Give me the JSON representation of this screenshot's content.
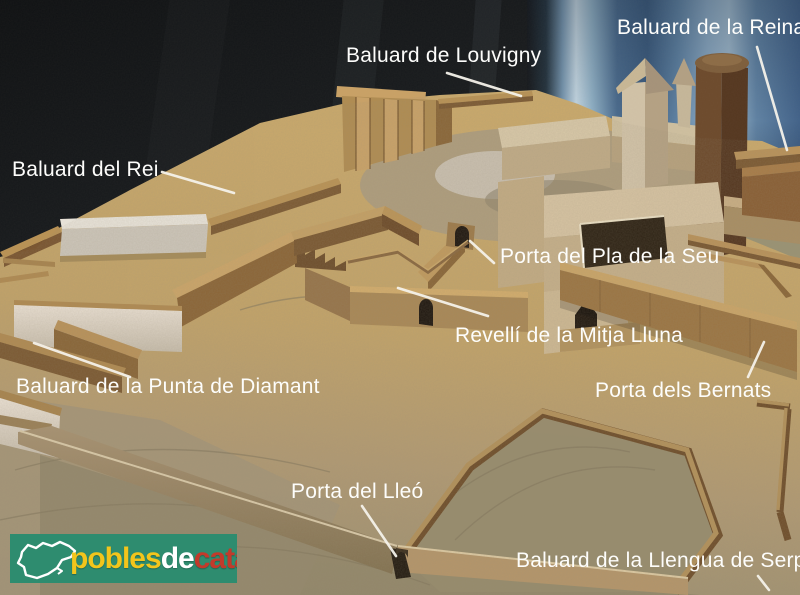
{
  "annotations": {
    "reina": "Baluard de la Reina",
    "louvigny": "Baluard de Louvigny",
    "rei": "Baluard del Rei",
    "pla_seu": "Porta del Pla de la Seu",
    "revelli": "Revellí de la Mitja Lluna",
    "diamant": "Baluard de la Punta de Diamant",
    "bernats": "Porta dels Bernats",
    "lleo": "Porta del Lleó",
    "serp": "Baluard de la Llengua de Serp"
  },
  "annotation_style": {
    "text_color": "#ffffff",
    "leader_color": "#f5f2ea"
  },
  "watermark": {
    "word1": "pobles",
    "word2": "de",
    "word3": "catalunya",
    "bg_color": "#2e8c6f",
    "word1_color": "#f2c51c",
    "word2_color": "#ffffff",
    "word3_color": "#c23a2b"
  }
}
